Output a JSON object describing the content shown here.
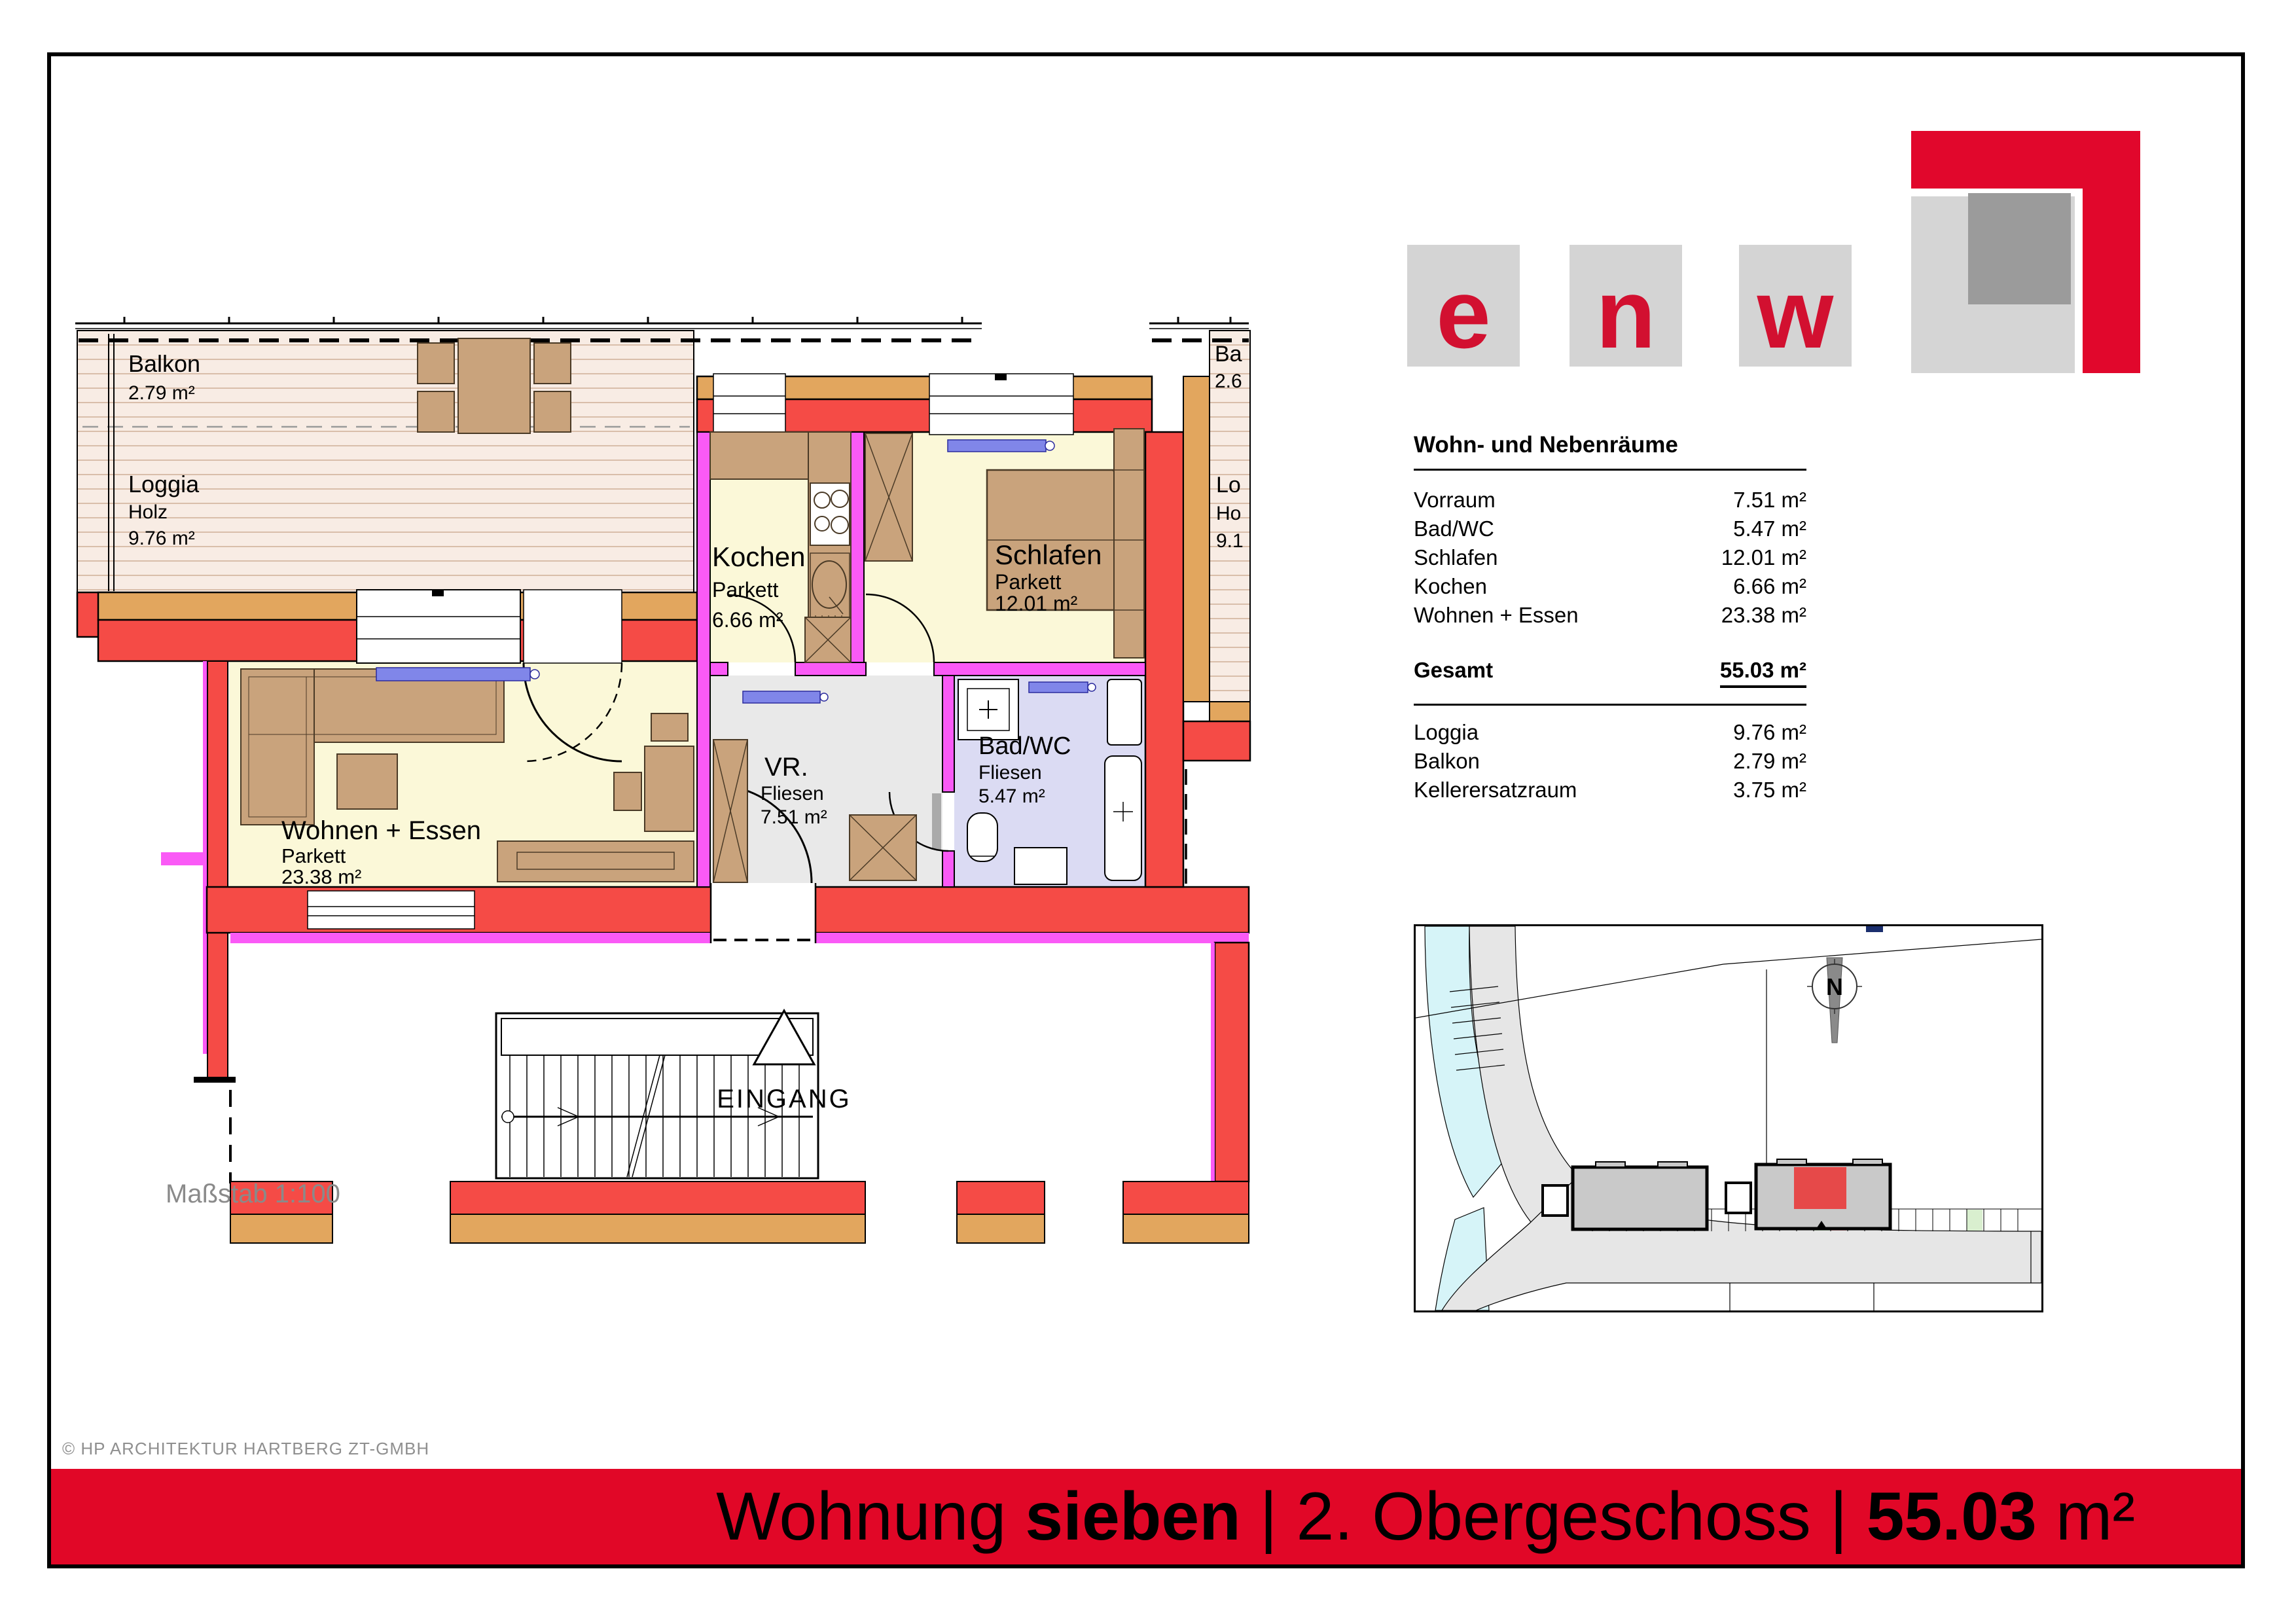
{
  "page": {
    "copyright": "© HP ARCHITEKTUR HARTBERG ZT-GMBH",
    "scale_label": "Maßstab 1:100",
    "title": {
      "pre": "Wohnung ",
      "name": "sieben",
      "mid": " | 2. Obergeschoss | ",
      "area": "55.03",
      "suffix": " m²"
    }
  },
  "colors": {
    "band_red": "#e10727",
    "wall_red": "#f54b46",
    "wall_wood_orange": "#e2a65e",
    "partition_magenta": "#fa5af6",
    "room_floor_yellow": "#fbf8d8",
    "deck_floor": "#f8ece4",
    "vr_floor_gray": "#e9e9e9",
    "bath_floor_lavender": "#dbdbf3",
    "furniture_tan": "#c9a37c",
    "radiator_blue": "#8086e9",
    "logo_letter_red": "#d21030",
    "site_highlight_red": "#e64949"
  },
  "logo": {
    "letters": [
      "e",
      "n",
      "w"
    ]
  },
  "legend": {
    "title": "Wohn- und Nebenräume",
    "rows": [
      {
        "label": "Vorraum",
        "value": "7.51 m²"
      },
      {
        "label": "Bad/WC",
        "value": "5.47 m²"
      },
      {
        "label": "Schlafen",
        "value": "12.01 m²"
      },
      {
        "label": "Kochen",
        "value": "6.66 m²"
      },
      {
        "label": "Wohnen + Essen",
        "value": "23.38 m²"
      }
    ],
    "total": {
      "label": "Gesamt",
      "value": "55.03 m²"
    },
    "outdoor": [
      {
        "label": "Loggia",
        "value": "9.76 m²"
      },
      {
        "label": "Balkon",
        "value": "2.79 m²"
      },
      {
        "label": "Kellerersatzraum",
        "value": "3.75 m²"
      }
    ]
  },
  "plan": {
    "balkon": {
      "name": "Balkon",
      "area": "2.79 m²"
    },
    "loggia": {
      "name": "Loggia",
      "material": "Holz",
      "area": "9.76 m²"
    },
    "wohnen": {
      "name": "Wohnen + Essen",
      "material": "Parkett",
      "area": "23.38 m²"
    },
    "kochen": {
      "name": "Kochen",
      "material": "Parkett",
      "area": "6.66 m²"
    },
    "schlafen": {
      "name": "Schlafen",
      "material": "Parkett",
      "area": "12.01 m²"
    },
    "vr": {
      "name": "VR.",
      "material": "Fliesen",
      "area": "7.51 m²"
    },
    "bad": {
      "name": "Bad/WC",
      "material": "Fliesen",
      "area": "5.47 m²"
    },
    "eingang": "EINGANG",
    "neighbor": {
      "balkon_cut": "Ba",
      "balkon_area_cut": "2.6",
      "loggia_cut": "Lo",
      "holz_cut": "Ho",
      "area_cut": "9.1"
    },
    "north_letter": "N"
  }
}
